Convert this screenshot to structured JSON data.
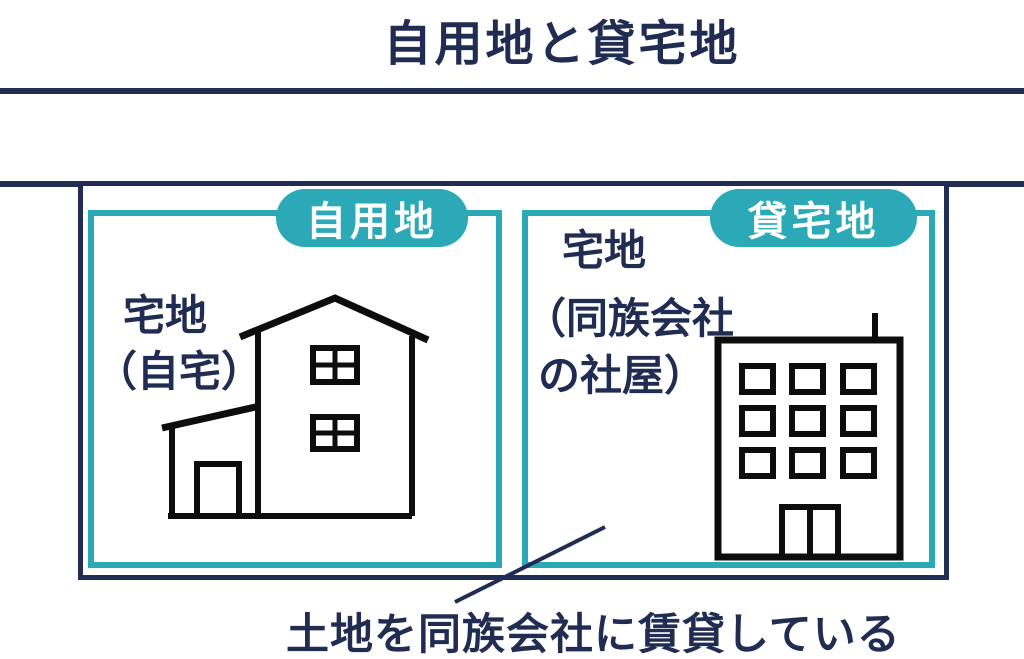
{
  "title": "自用地と貸宅地",
  "colors": {
    "navy": "#212c52",
    "teal": "#2ba9b7",
    "ink": "#0d0d0d",
    "background": "#ffffff"
  },
  "panels": {
    "left": {
      "badge": "自用地",
      "caption_lines": [
        "宅地",
        "（自宅）"
      ],
      "illustration": "house-icon"
    },
    "right": {
      "badge": "貸宅地",
      "caption_lines": [
        "宅地",
        "（同族会社",
        "の社屋）"
      ],
      "illustration": "office-building-icon"
    }
  },
  "footnote": "土地を同族会社に賃貸している"
}
